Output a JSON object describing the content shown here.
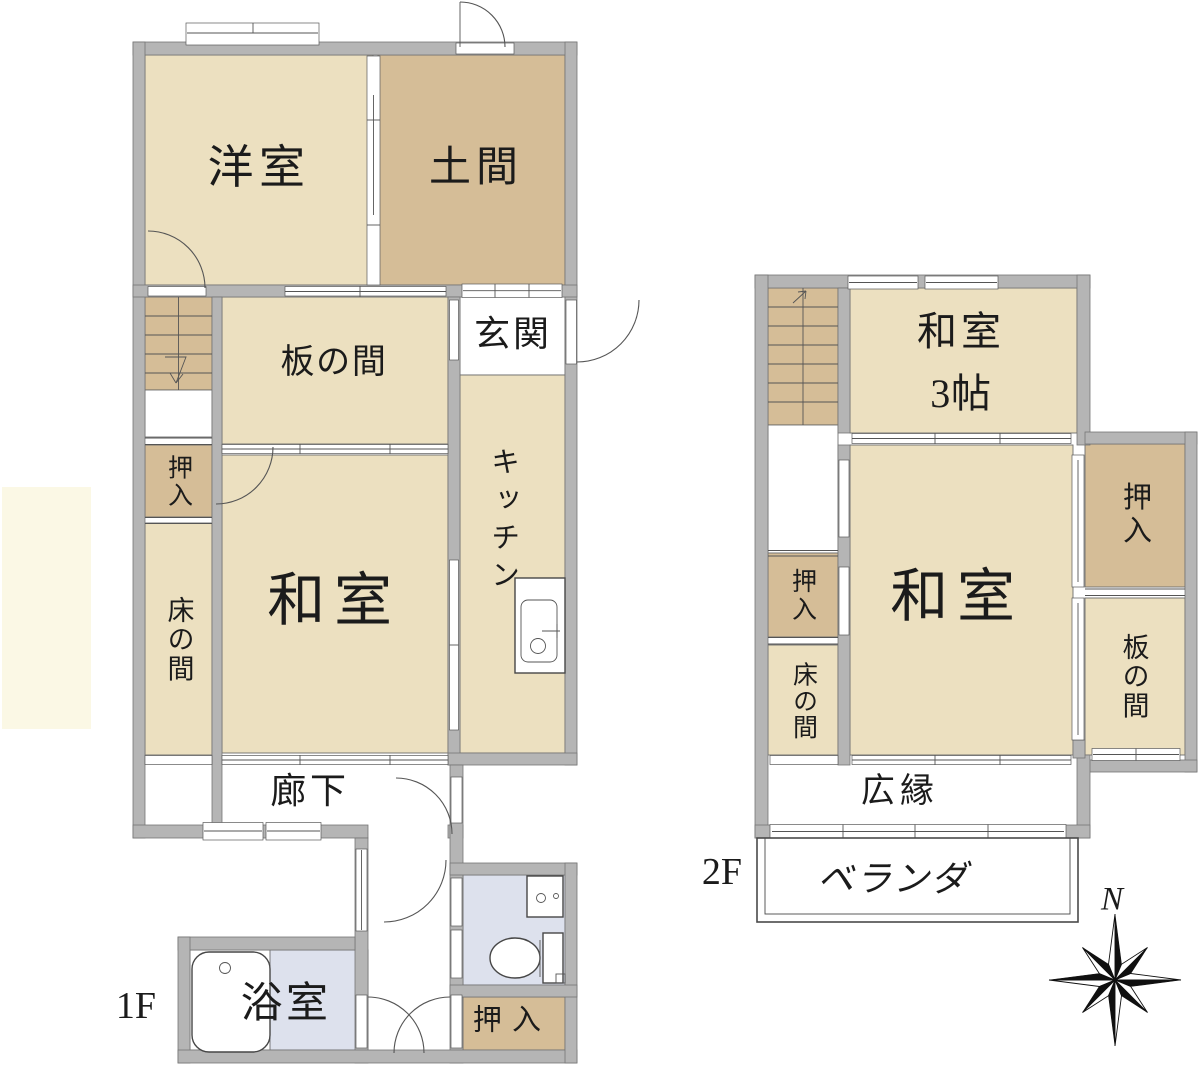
{
  "palette": {
    "wall": "#b5b5b5",
    "room_cream": "#ece0c0",
    "room_tan": "#d5bd97",
    "wet_blue": "#dde1ed",
    "accent_pale": "#fbf8e5",
    "bg": "#ffffff",
    "line": "#3a3a3a"
  },
  "compass": {
    "north": "N"
  },
  "f1": {
    "floor_label": "1F",
    "youshitsu": "洋室",
    "doma": "土間",
    "itanoma": "板の間",
    "genkan": "玄関",
    "kitchen": "キッチン",
    "oshiire_upper": "押入",
    "tokonoma": "床の間",
    "washitsu": "和室",
    "rouka": "廊下",
    "yokushitsu": "浴室",
    "oshiire_lower": "押入"
  },
  "f2": {
    "floor_label": "2F",
    "washitsu_small": "和室",
    "washitsu_small_size": "3帖",
    "washitsu": "和室",
    "oshiire_right": "押入",
    "itanoma": "板の間",
    "oshiire_left": "押入",
    "tokonoma": "床の間",
    "hiroen": "広縁",
    "veranda": "ベランダ"
  }
}
